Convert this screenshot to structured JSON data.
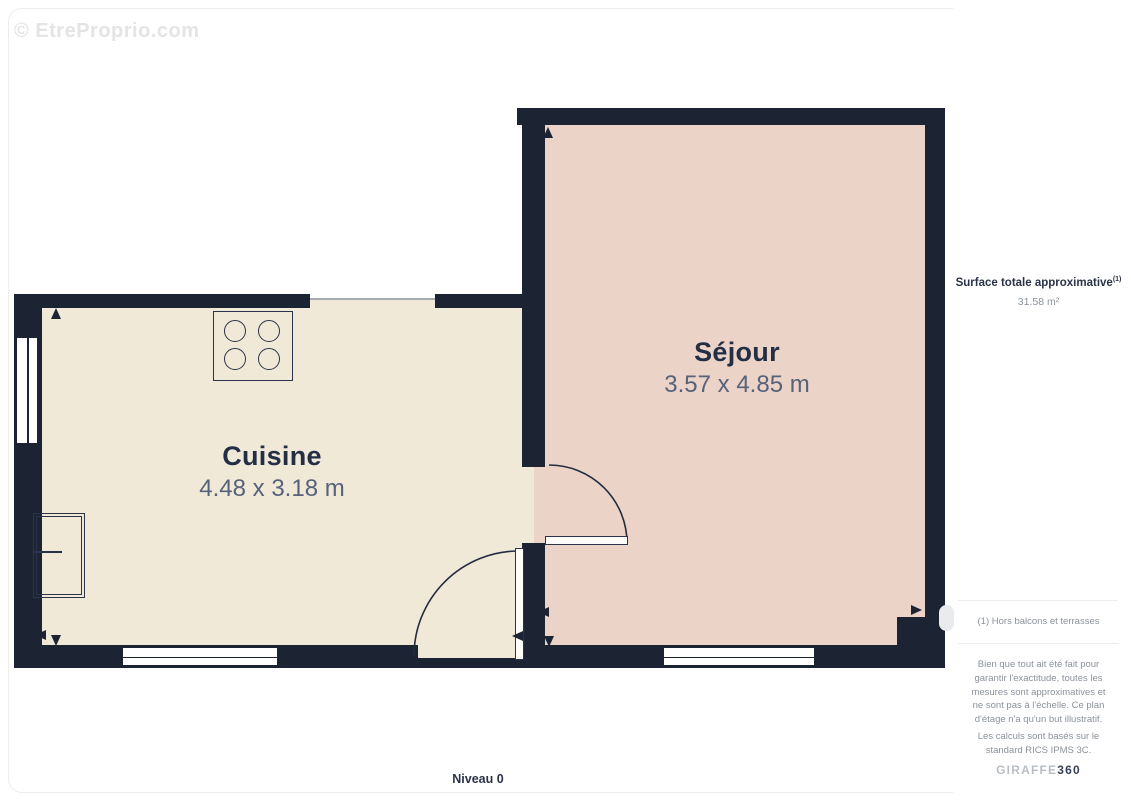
{
  "watermark": "© EtreProprio.com",
  "floor_label": "Niveau 0",
  "rooms": [
    {
      "id": "cuisine",
      "name": "Cuisine",
      "dimensions": "4.48 x 3.18 m"
    },
    {
      "id": "sejour",
      "name": "Séjour",
      "dimensions": "3.57 x 4.85 m"
    }
  ],
  "sidebar": {
    "surface_title": "Surface totale approximative",
    "surface_title_superscript": "(1)",
    "surface_value": "31.58 m²",
    "footnote": "(1) Hors balcons et terrasses",
    "disclaimer_1": "Bien que tout ait été fait pour garantir l'exactitude, toutes les mesures sont approximatives et ne sont pas à l'échelle. Ce plan d'étage n'a qu'un but illustratif.",
    "disclaimer_2": "Les calculs sont basés sur le standard RICS IPMS 3C.",
    "logo_primary": "GIRAFFE",
    "logo_suffix": "360"
  },
  "colors": {
    "wall": "#1c2433",
    "kitchen_floor": "#f0e9d8",
    "sejour_floor": "#ebd3c7",
    "room_name_text": "#242e45",
    "room_dims_text": "#55627a",
    "muted_text": "#8b929b",
    "navy_text": "#2a3347",
    "divider": "#ececec",
    "watermark_text": "#e4e4e4",
    "logo_gray": "#b9bec5",
    "logo_dark": "#39415a"
  }
}
